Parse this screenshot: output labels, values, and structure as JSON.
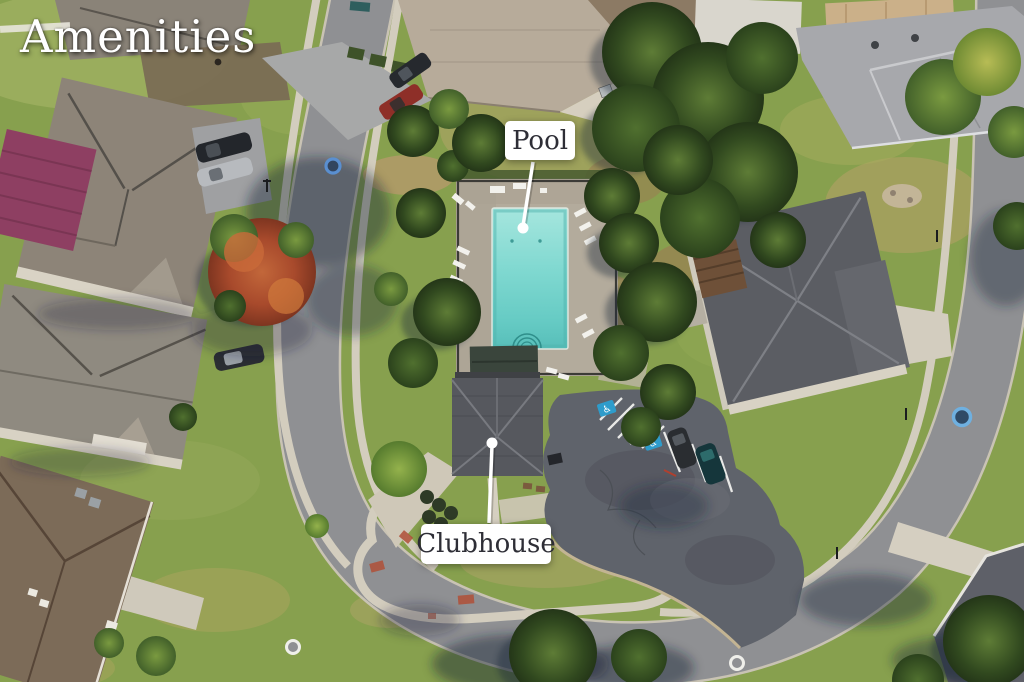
{
  "photo": {
    "overlay_title": "Amenities",
    "callouts": [
      {
        "label": "Pool"
      },
      {
        "label": "Clubhouse"
      }
    ],
    "pavement_icon": "♿",
    "colors": {
      "pool_water": "#7FD8D0",
      "label_text": "#2E2E36",
      "label_background": "#FFFFFF",
      "road": "#8F9093",
      "parking_asphalt": "#5F636B",
      "grass": "#87A04E",
      "accessible_stall_blue": "#2E9CCB",
      "title_text": "#FFFFFF"
    }
  }
}
